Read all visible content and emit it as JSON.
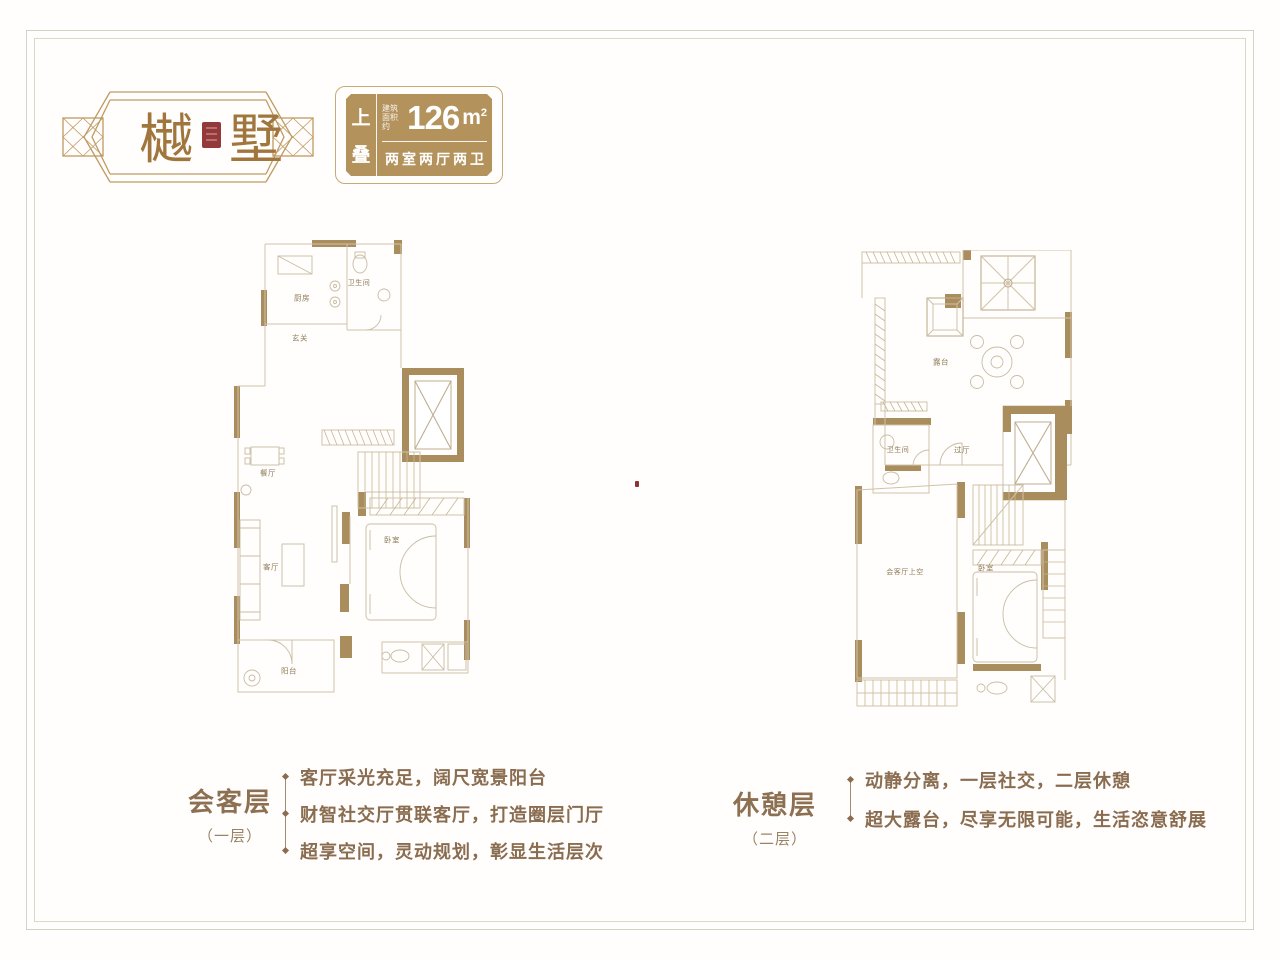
{
  "logo": {
    "char_left": "樾",
    "char_right": "墅"
  },
  "badge": {
    "tag_char1": "上",
    "tag_char2": "叠",
    "area_prefix_l1": "建筑",
    "area_prefix_l2": "面积约",
    "area_number": "126",
    "area_unit": "m",
    "area_sup": "2",
    "layout_text": "两室两厅两卫"
  },
  "plans": {
    "left": {
      "labels": {
        "kitchen": "厨房",
        "bathroom": "卫生间",
        "foyer": "玄关",
        "dining": "餐厅",
        "living": "客厅",
        "bedroom": "卧室",
        "balcony": "阳台"
      }
    },
    "right": {
      "labels": {
        "terrace": "露台",
        "bathroom": "卫生间",
        "hall": "过厅",
        "void_above_living": "会客厅上空",
        "bedroom": "卧室"
      }
    }
  },
  "notes": {
    "left": {
      "title": "会客层",
      "subtitle": "（一层）",
      "bullets": [
        "客厅采光充足，阔尺宽景阳台",
        "财智社交厅贯联客厅，打造圈层门厅",
        "超享空间，灵动规划，彰显生活层次"
      ]
    },
    "right": {
      "title": "休憩层",
      "subtitle": "（二层）",
      "bullets": [
        "动静分离，一层社交，二层休憩",
        "超大露台，尽享无限可能，生活恣意舒展"
      ]
    }
  },
  "colors": {
    "badge_gold": "#b3925c",
    "wall_tan": "#aa8d5d",
    "plan_line": "#cfc2aa",
    "text_brown": "#8a6d50",
    "seal_red": "#93393a",
    "frame_gray": "#d8d2c4"
  }
}
